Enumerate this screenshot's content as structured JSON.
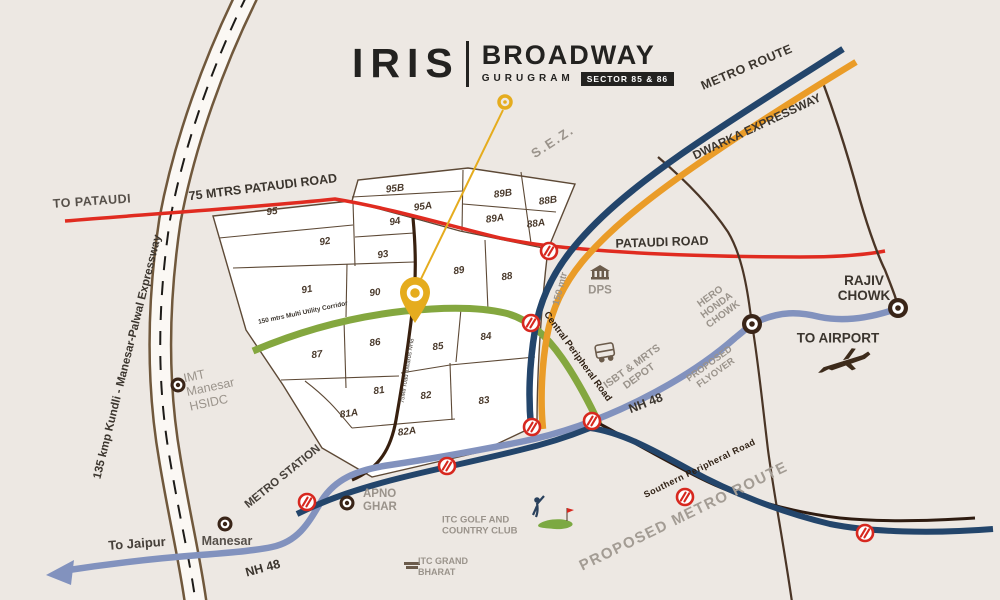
{
  "brand": {
    "name": "IRIS",
    "divider": "|",
    "title": "BROADWAY",
    "city": "GURUGRAM",
    "badge": "SECTOR 85 & 86"
  },
  "sectors": [
    "95",
    "95B",
    "95A",
    "94",
    "92",
    "93",
    "91",
    "90",
    "89",
    "88",
    "89B",
    "89A",
    "88B",
    "88A",
    "87",
    "86",
    "85",
    "84",
    "81",
    "81A",
    "82",
    "82A",
    "83"
  ],
  "labels": {
    "to_pataudi": "TO PATAUDI",
    "mtrs_pataudi_road": "75 MTRS PATAUDI ROAD",
    "pataudi_road": "PATAUDI ROAD",
    "metro_route": "METRO ROUTE",
    "dwarka_expressway": "DWARKA EXPRESSWAY",
    "sez": "S.E.Z.",
    "kmp_expressway": "135 kmp Kundli - Manesar-Palwal Expressway",
    "rajiv_chowk": "RAJIV CHOWK",
    "to_airport": "TO AIRPORT",
    "dps": "DPS",
    "imt_manesar": "IMT Manesar HSIDC",
    "metro_station": "METRO STATION",
    "apno_ghar": "APNO GHAR",
    "manesar": "Manesar",
    "to_jaipur": "To Jaipur",
    "nh48_sw": "NH 48",
    "nh48_mid": "NH 48",
    "southern_peripheral_road": "Southern Peripheral Road",
    "proposed_metro_route": "PROPOSED METRO ROUTE",
    "hero_honda_chowk": "HERO HONDA CHOWK",
    "proposed_flyover": "PROPOSED FLYOVER",
    "isbt_mrts_depot": "ISBT & MRTS DEPOT",
    "central_peripheral_road": "Central Peripheral Road",
    "mtr_150": "150 mtr",
    "multi_utility_corridor": "150 mtrs Multi Utility Corridor",
    "road_75mtr": "75Mtr road towards NH8",
    "itc_golf": "ITC GOLF AND COUNTRY CLUB",
    "itc_grand": "ITC GRAND BHARAT"
  },
  "legend_colors": {
    "metro_route": "#23456B",
    "dwarka_expressway": "#EA9C28",
    "nh48": "#8292BE",
    "pataudi_road": "#E02B20",
    "multi_utility_corridor": "#84A73F",
    "southern_peripheral_road": "#2E1B10",
    "proposed_metro_route": "#23456B",
    "location_pin": "#E5AC1E"
  }
}
